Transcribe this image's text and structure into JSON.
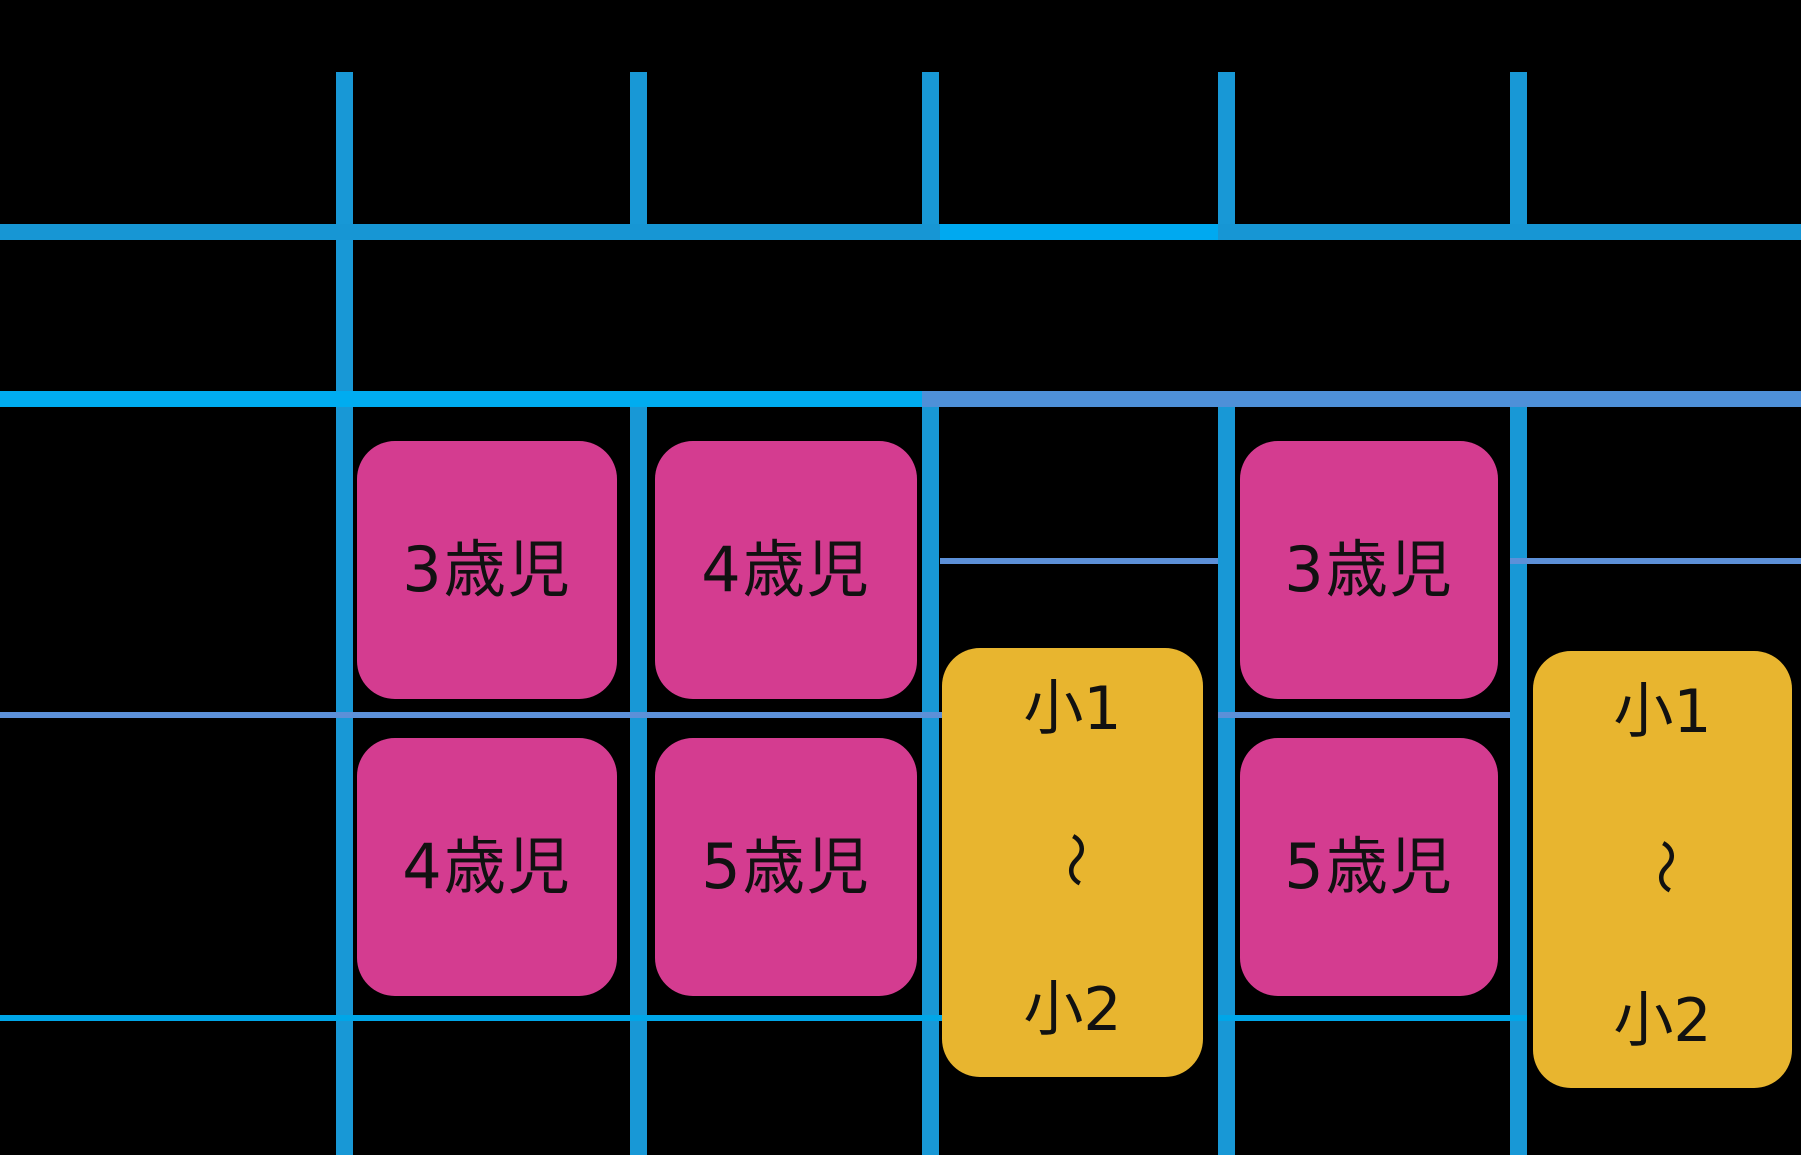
{
  "figure": {
    "description_text": "",
    "colors": {
      "background": "#000000",
      "grid_cyan": "#1898D6",
      "grid_cyan_medium": "#1796D4",
      "grid_cyan_bright": "#00ABF0",
      "grid_slate_blue": "#4E90D8",
      "thin_line_slate": "#5C90D8",
      "thin_line_cyan": "#00A6E8",
      "card_pink": "#D43C90",
      "card_yellow": "#E8B52F",
      "card_text": "#111111"
    },
    "cards": [
      {
        "label": "3歳児",
        "color": "pink",
        "column": 2,
        "row": 1
      },
      {
        "label": "4歳児",
        "color": "pink",
        "column": 3,
        "row": 1
      },
      {
        "label": "3歳児",
        "color": "pink",
        "column": 5,
        "row": 1
      },
      {
        "label": "4歳児",
        "color": "pink",
        "column": 2,
        "row": 2
      },
      {
        "label": "5歳児",
        "color": "pink",
        "column": 3,
        "row": 2
      },
      {
        "label": "5歳児",
        "color": "pink",
        "column": 5,
        "row": 2
      },
      {
        "label_lines": [
          "小1",
          "〜",
          "小2"
        ],
        "color": "yellow",
        "column": 4,
        "row": "1-2"
      },
      {
        "label_lines": [
          "小1",
          "〜",
          "小2"
        ],
        "color": "yellow",
        "column": 6,
        "row": "1-2"
      }
    ]
  }
}
